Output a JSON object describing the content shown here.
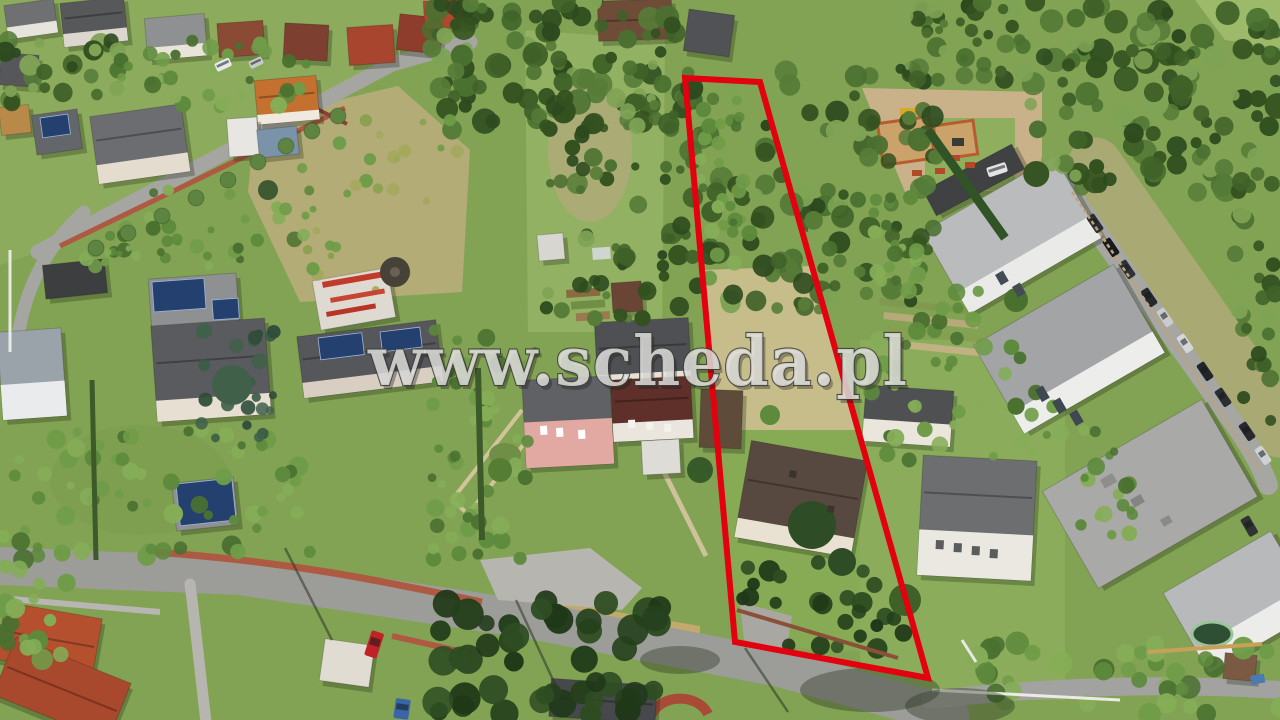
{
  "scene": {
    "type": "aerial-photograph",
    "subject": "suburban neighbourhood with a vacant elongated land parcel outlined in red"
  },
  "watermark": {
    "text": "www.scheda.pl"
  },
  "parcel_boundary": {
    "points": "685,78 760,82 928,678 735,642",
    "stroke_color": "#e3000f"
  },
  "palette": {
    "foliage_dark": "#33511f",
    "foliage_mid": "#4a7030",
    "lawn_green": "#83a354",
    "glade_green": "#93b162",
    "dry_meadow": "#c6bd8b",
    "dry_hill": "#b3ac77",
    "road_gray": "#9c9c99",
    "lane_gray": "#b7b5b0",
    "sidewalk_brick": "#ae5a43",
    "roof_red": "#a8452f",
    "roof_orange": "#c4702f",
    "roof_dark_gray": "#55575a",
    "roof_weathered_brown": "#584940",
    "wall_white": "#eaeae8",
    "wall_pink": "#e2a9a3",
    "solar_panel_blue": "#24406e",
    "construction_sand": "#c9b28a",
    "car_red": "#bf2328",
    "car_blue": "#3a66a8"
  }
}
